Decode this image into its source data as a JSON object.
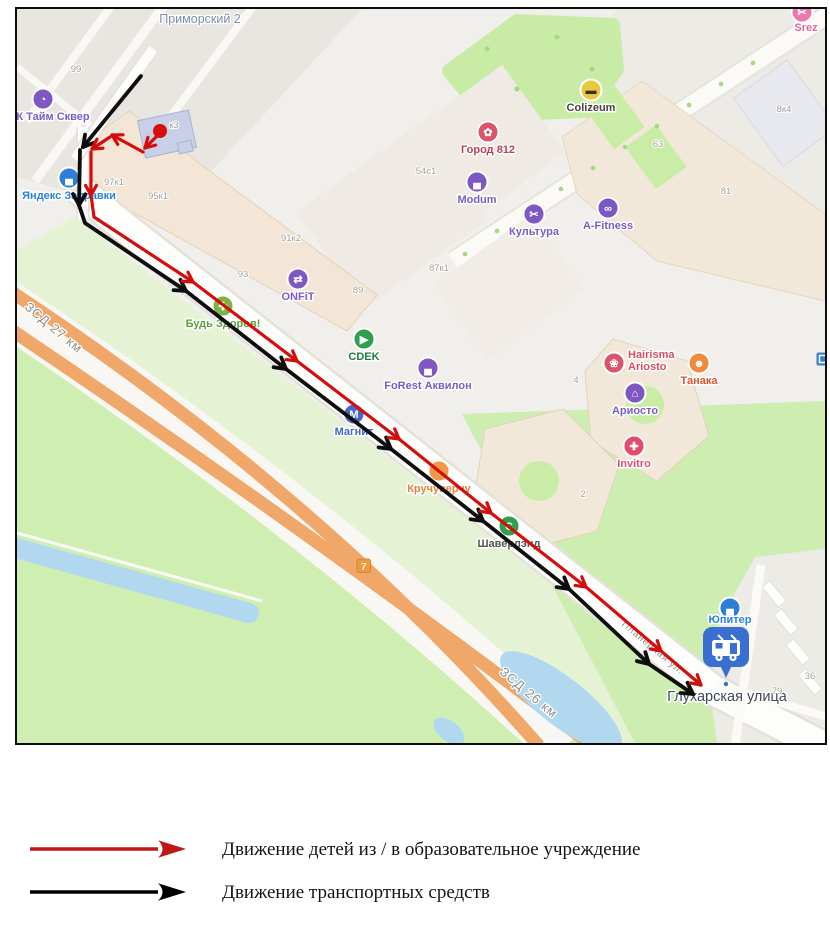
{
  "map": {
    "district_label": "Приморский 2",
    "stop_label": "Глухарская улица",
    "road_badge": "7",
    "route_colors": {
      "children": "#d40d0d",
      "vehicles": "#0d0d0d"
    },
    "street_labels": [
      {
        "t": "ЗСД 27 км",
        "x": 34,
        "y": 322,
        "r": 40,
        "s": 13
      },
      {
        "t": "ЗСД 26 км",
        "x": 509,
        "y": 687,
        "r": 40,
        "s": 13
      },
      {
        "t": "Планерная ул.",
        "x": 634,
        "y": 641,
        "r": 40,
        "s": 9.5
      }
    ],
    "house_numbers": [
      {
        "t": "99",
        "x": 59,
        "y": 63
      },
      {
        "t": "к3",
        "x": 157,
        "y": 119
      },
      {
        "t": "97к1",
        "x": 97,
        "y": 176
      },
      {
        "t": "95к1",
        "x": 141,
        "y": 190
      },
      {
        "t": "93",
        "x": 226,
        "y": 268
      },
      {
        "t": "91к2",
        "x": 274,
        "y": 232
      },
      {
        "t": "89",
        "x": 341,
        "y": 284
      },
      {
        "t": "87к1",
        "x": 422,
        "y": 262
      },
      {
        "t": "54с1",
        "x": 409,
        "y": 165
      },
      {
        "t": "63",
        "x": 641,
        "y": 138
      },
      {
        "t": "81",
        "x": 709,
        "y": 185
      },
      {
        "t": "8к4",
        "x": 767,
        "y": 103
      },
      {
        "t": "4",
        "x": 559,
        "y": 374
      },
      {
        "t": "2",
        "x": 566,
        "y": 488
      },
      {
        "t": "36",
        "x": 793,
        "y": 670
      },
      {
        "t": "79",
        "x": 760,
        "y": 685
      }
    ],
    "pois": [
      {
        "id": "time-square",
        "label": "К Тайм Сквер",
        "x": 26,
        "y": 90,
        "bg": "#7e57c2",
        "fg": "#7a5cc6",
        "glyph": "◔",
        "lx": 36
      },
      {
        "id": "yandex-zapravki",
        "label": "Яндекс Заправки",
        "x": 52,
        "y": 169,
        "bg": "#2d7fd6",
        "fg": "#2884d9",
        "glyph": "▄"
      },
      {
        "id": "gorod-812",
        "label": "Город 812",
        "x": 471,
        "y": 123,
        "bg": "#d9556b",
        "fg": "#b8434f",
        "glyph": "✿"
      },
      {
        "id": "colizeum",
        "label": "Colizeum",
        "x": 574,
        "y": 81,
        "bg": "#e9c93b",
        "fg": "#45453b",
        "glyph": "▬",
        "glyph_color": "#332f2a"
      },
      {
        "id": "srez",
        "label": "Srez",
        "x": 785,
        "y": 3,
        "bg": "#ec79ae",
        "fg": "#e0659c",
        "glyph": "✂",
        "lx": 789,
        "ly": 22
      },
      {
        "id": "modum",
        "label": "Modum",
        "x": 460,
        "y": 173,
        "bg": "#7e57c2",
        "fg": "#7a5cc6",
        "glyph": "▄"
      },
      {
        "id": "kultura",
        "label": "Культура",
        "x": 517,
        "y": 205,
        "bg": "#7e57c2",
        "fg": "#7a5cc6",
        "glyph": "✂"
      },
      {
        "id": "a-fitness",
        "label": "A-Fitness",
        "x": 591,
        "y": 199,
        "bg": "#7e57c2",
        "fg": "#7a5cc6",
        "glyph": "∞"
      },
      {
        "id": "onfit",
        "label": "ONFiT",
        "x": 281,
        "y": 270,
        "bg": "#7e57c2",
        "fg": "#7a5cc6",
        "glyph": "⇄"
      },
      {
        "id": "bud-zdorov",
        "label": "Будь Здоров!",
        "x": 206,
        "y": 297,
        "bg": "#7cb342",
        "fg": "#58a23c",
        "glyph": "✚"
      },
      {
        "id": "cdek",
        "label": "CDEK",
        "x": 347,
        "y": 330,
        "bg": "#2e9e4f",
        "fg": "#1f7a3d",
        "glyph": "▶"
      },
      {
        "id": "forest-akvilon",
        "label": "FoRest Аквилон",
        "x": 411,
        "y": 359,
        "bg": "#7e57c2",
        "fg": "#7a5cc6",
        "glyph": "▄"
      },
      {
        "id": "magnit",
        "label": "Магнит",
        "x": 337,
        "y": 405,
        "bg": "#4a67c8",
        "fg": "#3f68c9",
        "glyph": "М"
      },
      {
        "id": "kruchuverchu",
        "label": "Кручуверчу",
        "x": 422,
        "y": 462,
        "bg": "#ef9846",
        "fg": "#e2853a",
        "glyph": "◔"
      },
      {
        "id": "shaverlend",
        "label": "Шаверлэнд",
        "x": 492,
        "y": 517,
        "bg": "#2e9e4f",
        "fg": "#53594f",
        "glyph": "Є"
      },
      {
        "id": "hairisma-ariosto",
        "label": "Hairisma Ariosto",
        "x": 597,
        "y": 354,
        "bg": "#d9556b",
        "fg": "#d44f66",
        "glyph": "❀",
        "lines": [
          "Hairisma",
          "Ariosto"
        ],
        "lx": 611,
        "ly": 349
      },
      {
        "id": "tanaka",
        "label": "Танака",
        "x": 682,
        "y": 354,
        "bg": "#ef8b3d",
        "fg": "#d9542e",
        "glyph": "☻"
      },
      {
        "id": "ariosto",
        "label": "Ариосто",
        "x": 618,
        "y": 384,
        "bg": "#7e57c2",
        "fg": "#7a5cc6",
        "glyph": "⌂"
      },
      {
        "id": "invitro",
        "label": "Invitro",
        "x": 617,
        "y": 437,
        "bg": "#e8486e",
        "fg": "#e34f75",
        "glyph": "✚"
      },
      {
        "id": "jupiter",
        "label": "Юпитер",
        "x": 713,
        "y": 599,
        "bg": "#2d7fd6",
        "fg": "#2884d9",
        "glyph": "▄",
        "ly": 614
      }
    ],
    "mini_poi": {
      "id": "transit-indicator",
      "x": 806,
      "y": 350,
      "bg": "#3b7fd0",
      "glyph": "▣"
    }
  },
  "legend": {
    "items": [
      {
        "id": "children-route",
        "color": "#c11616",
        "label": "Движение детей из / в образовательное учреждение"
      },
      {
        "id": "vehicle-route",
        "color": "#000000",
        "label": "Движение транспортных средств"
      }
    ]
  }
}
